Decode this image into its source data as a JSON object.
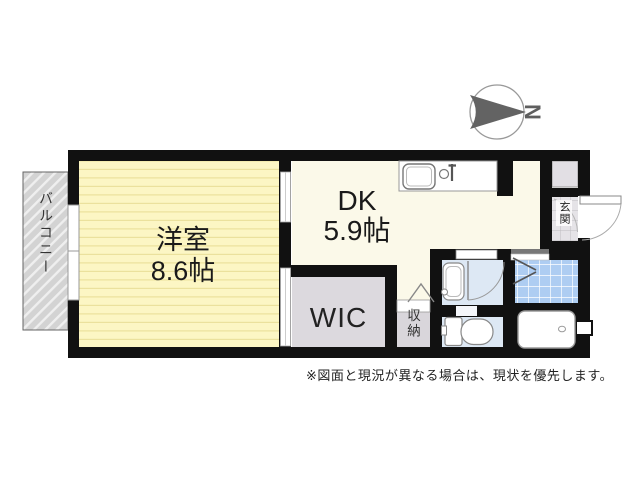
{
  "window": {
    "width": 640,
    "height": 480
  },
  "compass": {
    "letter": "N"
  },
  "floorplan": {
    "balcony": {
      "label": "バルコニー"
    },
    "western_room": {
      "name": "洋室",
      "size": "8.6帖"
    },
    "dining_kitchen": {
      "name": "DK",
      "size": "5.9帖"
    },
    "wic": {
      "label": "WIC"
    },
    "storage": {
      "label": "収納"
    },
    "entrance": {
      "label": "玄関"
    }
  },
  "note": {
    "text": "※図面と現況が異なる場合は、現状を優先します。"
  },
  "colors": {
    "wall": "#111111",
    "western_room_fill": "#fcf6c4",
    "western_room_stripe": "#ebe19d",
    "dk_fill": "#fbf9e9",
    "wic_fill": "#dcd9de",
    "storage_fill": "#d9d6db",
    "washroom_fill": "#dde8f4",
    "toilet_fill": "#dde8f4",
    "bath_tile_fill": "#aecdf2",
    "entrance_tile_fill": "#e5e3e7",
    "closet_fill": "#e2dfe4",
    "balcony_fill": "#d3d3d3",
    "compass_color": "#636363"
  }
}
